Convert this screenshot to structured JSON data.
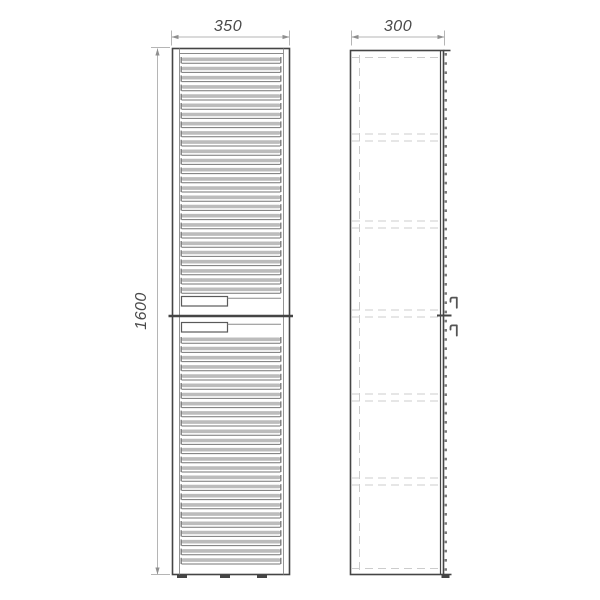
{
  "drawing": {
    "background": "#ffffff",
    "colors": {
      "object_line": "#454545",
      "light_line": "#8a8a8a",
      "slat_fill": "#bcbcbc",
      "slat_edge": "#757575",
      "hidden_line": "#cccccc",
      "dim_line": "#b5b5b5",
      "dim_arrow": "#8f8f8f",
      "dim_text": "#4a4a4a"
    },
    "dimensions": {
      "width_label": "350",
      "depth_label": "300",
      "height_label": "1600"
    },
    "front_view": {
      "slat_pitch": 9.2,
      "slat_regions": [
        {
          "start_y": 57,
          "count": 26
        },
        {
          "start_y": 337,
          "count": 25
        }
      ],
      "handle_count": 2,
      "feet_x": [
        177,
        220,
        257
      ]
    },
    "side_view": {
      "shelves_y": [
        134,
        221,
        310,
        394,
        478
      ],
      "top_hidden_y": 57.5,
      "bottom_hidden_y": 568.5,
      "hidden_vertical_x": 359.5,
      "handle_count": 2
    }
  }
}
